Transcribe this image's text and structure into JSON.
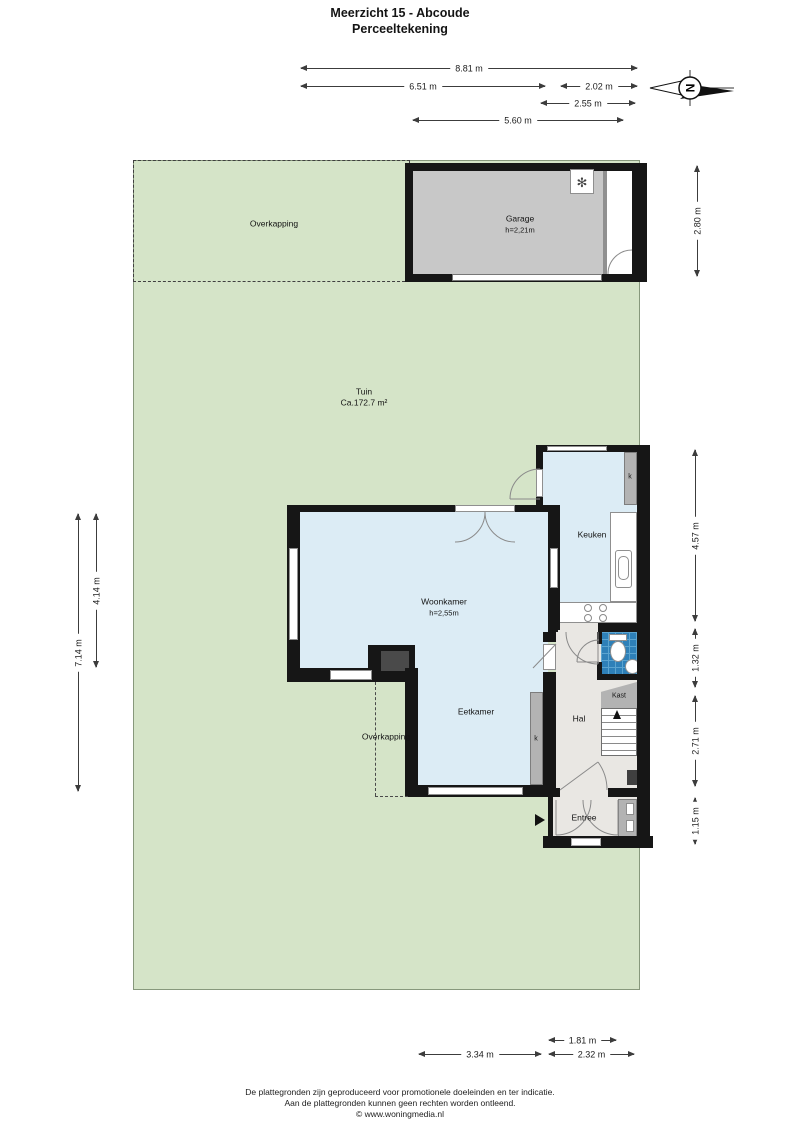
{
  "title": {
    "line1": "Meerzicht 15 - Abcoude",
    "line2": "Perceeltekening"
  },
  "compass": {
    "north_label": "N"
  },
  "icons": {
    "ventilation_glyph": "✻"
  },
  "plan": {
    "tuin": {
      "name": "Tuin",
      "area": "Ca.172.7 m²"
    },
    "overkapping_top": {
      "name": "Overkapping"
    },
    "overkapping_bottom": {
      "name": "Overkapping"
    },
    "garage": {
      "name": "Garage",
      "height": "h=2,21m"
    },
    "keuken": {
      "name": "Keuken"
    },
    "woonkamer": {
      "name": "Woonkamer",
      "height": "h=2,55m"
    },
    "eetkamer": {
      "name": "Eetkamer"
    },
    "hal": {
      "name": "Hal"
    },
    "kast": {
      "name": "Kast"
    },
    "kast_abbrev": "k",
    "entree": {
      "name": "Entree"
    }
  },
  "dimensions": {
    "top": [
      "8.81 m",
      "6.51 m",
      "2.02 m",
      "2.55 m",
      "5.60 m"
    ],
    "left": [
      "7.14 m",
      "4.14 m"
    ],
    "right_garage": "2.80 m",
    "right_house": [
      "4.57 m",
      "1.32 m",
      "2.71 m",
      "1.15 m"
    ],
    "bottom": [
      "1.81 m",
      "3.34 m",
      "2.32 m"
    ]
  },
  "footer": {
    "line1": "De plattegronden zijn geproduceerd voor promotionele doeleinden en ter indicatie.",
    "line2": "Aan de plattegronden kunnen geen rechten worden ontleend.",
    "line3": "© www.woningmedia.nl"
  },
  "colors": {
    "garden": "#d5e4c8",
    "room_blue": "#dcecf5",
    "hall_gray": "#e9e7e3",
    "garage_gray": "#c8c8c8",
    "wall": "#161616",
    "toilet_blue": "#2e80b8",
    "closet_gray": "#b3b3b3"
  }
}
